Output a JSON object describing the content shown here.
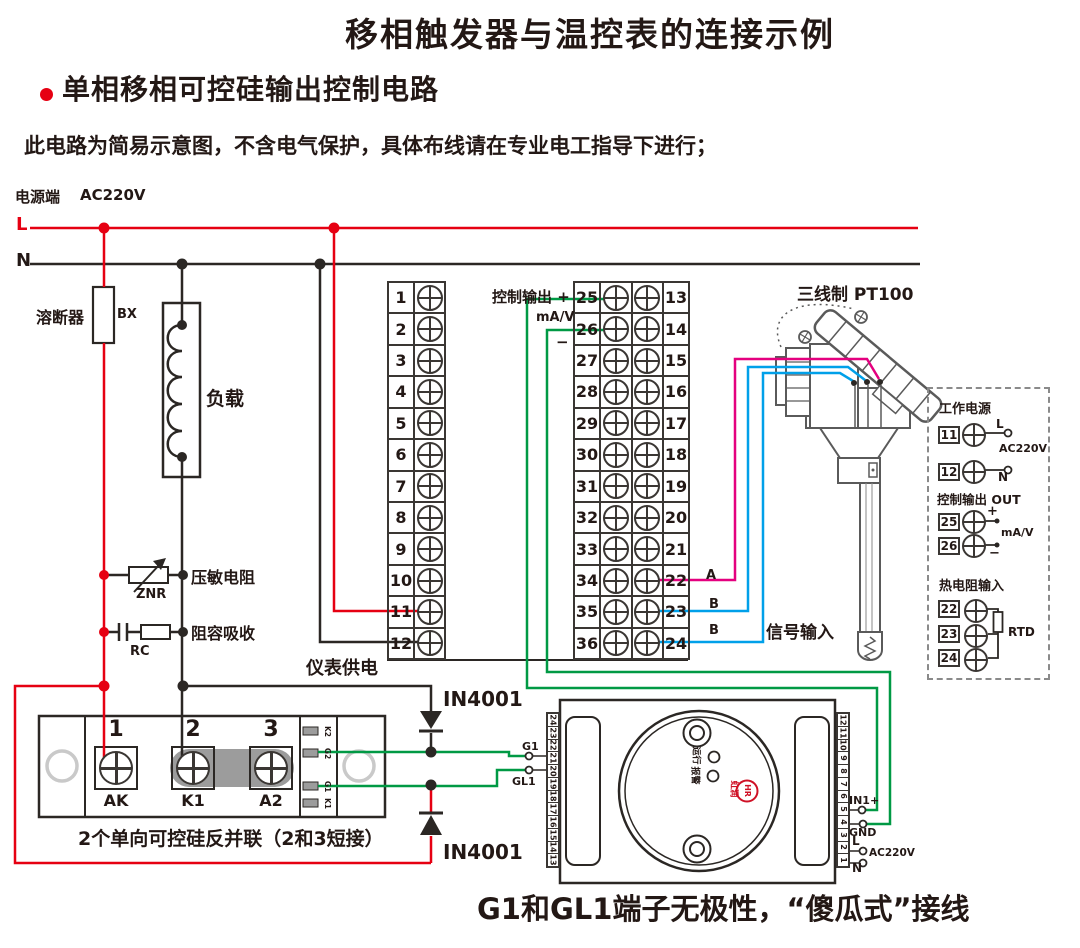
{
  "colors": {
    "red": "#e60012",
    "ink": "#2b2724",
    "green": "#009944",
    "blue": "#00a0e9",
    "magenta": "#e4007f",
    "gray": "#9c9c9c",
    "brand_red": "#cf1126"
  },
  "header": {
    "title": "移相触发器与温控表的连接示例",
    "bullet": "单相移相可控硅输出控制电路",
    "note": "此电路为简易示意图，不含电气保护，具体布线请在专业电工指导下进行；"
  },
  "power": {
    "source": "电源端",
    "voltage": "AC220V",
    "line_l": "L",
    "line_n": "N",
    "fuse": "溶断器",
    "fuse_code": "BX",
    "load": "负载",
    "varistor": "压敏电阻",
    "varistor_code": "ZNR",
    "rc": "阻容吸收",
    "rc_code": "RC"
  },
  "terminal_blocks": {
    "left_numbers": [
      "1",
      "2",
      "3",
      "4",
      "5",
      "6",
      "7",
      "8",
      "9",
      "10",
      "11",
      "12"
    ],
    "right_left_numbers": [
      "25",
      "26",
      "27",
      "28",
      "29",
      "30",
      "31",
      "32",
      "33",
      "34",
      "35",
      "36"
    ],
    "right_right_numbers": [
      "13",
      "14",
      "15",
      "16",
      "17",
      "18",
      "19",
      "20",
      "21",
      "22",
      "23",
      "24"
    ],
    "ctrl_out": "控制输出 +",
    "mav": "mA/V",
    "minus": "−",
    "meter_power": "仪表供电"
  },
  "sensor": {
    "title": "三线制 PT100",
    "wire_a": "A",
    "wire_b1": "B",
    "wire_b2": "B",
    "signal_input": "信号输入"
  },
  "side_panel": {
    "working_power": "工作电源",
    "t11": "11",
    "l": "L",
    "ac": "AC220V",
    "t12": "12",
    "n": "N",
    "ctrl_out": "控制输出 OUT",
    "t25": "25",
    "plus": "+",
    "mav": "mA/V",
    "t26": "26",
    "minus": "−",
    "rtd_input": "热电阻输入",
    "t22": "22",
    "t23": "23",
    "t24": "24",
    "rtd": "RTD"
  },
  "scr": {
    "n1": "1",
    "n2": "2",
    "n3": "3",
    "ak": "AK",
    "k1": "K1",
    "a2": "A2",
    "pins": [
      "K2",
      "G2",
      "G1",
      "K1"
    ],
    "caption": "2个单向可控硅反并联（2和3短接）"
  },
  "diodes": {
    "top": "IN4001",
    "bottom": "IN4001"
  },
  "trigger": {
    "left_strip": [
      "24",
      "23",
      "22",
      "21",
      "20",
      "19",
      "18",
      "17",
      "16",
      "15",
      "14",
      "13"
    ],
    "right_strip": [
      "12",
      "11",
      "10",
      "9",
      "8",
      "7",
      "6",
      "5",
      "4",
      "3",
      "2",
      "1"
    ],
    "g1": "G1",
    "gl1": "GL1",
    "in1": "IN1+",
    "gnd": "GND",
    "l": "L",
    "ac": "AC220V",
    "n": "N",
    "run": "运行",
    "alarm": "报警",
    "brand": "虹润",
    "brand_mark": "HR"
  },
  "footer": {
    "note": "G1和GL1端子无极性，“傻瓜式”接线"
  }
}
